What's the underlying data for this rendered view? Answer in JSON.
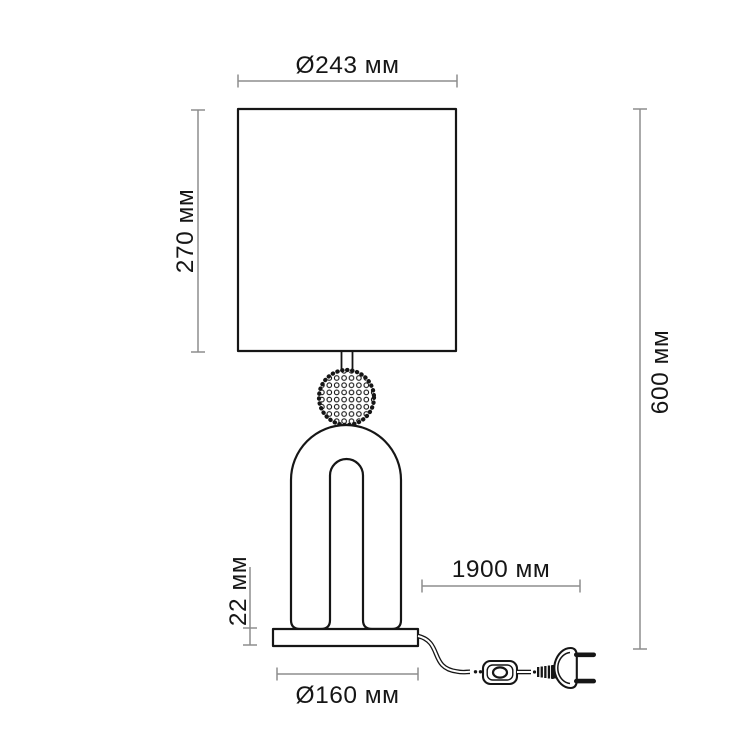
{
  "diagram": {
    "unit": "мм",
    "labels": {
      "shade_diameter": "Ø243 мм",
      "shade_height": "270 мм",
      "total_height": "600 мм",
      "base_height": "22 мм",
      "cord_length": "1900 мм",
      "base_diameter": "Ø160 мм"
    },
    "colors": {
      "outline": "#161616",
      "dimension_line": "#8d8d8d",
      "label_text": "#161616",
      "background": "#ffffff"
    }
  }
}
